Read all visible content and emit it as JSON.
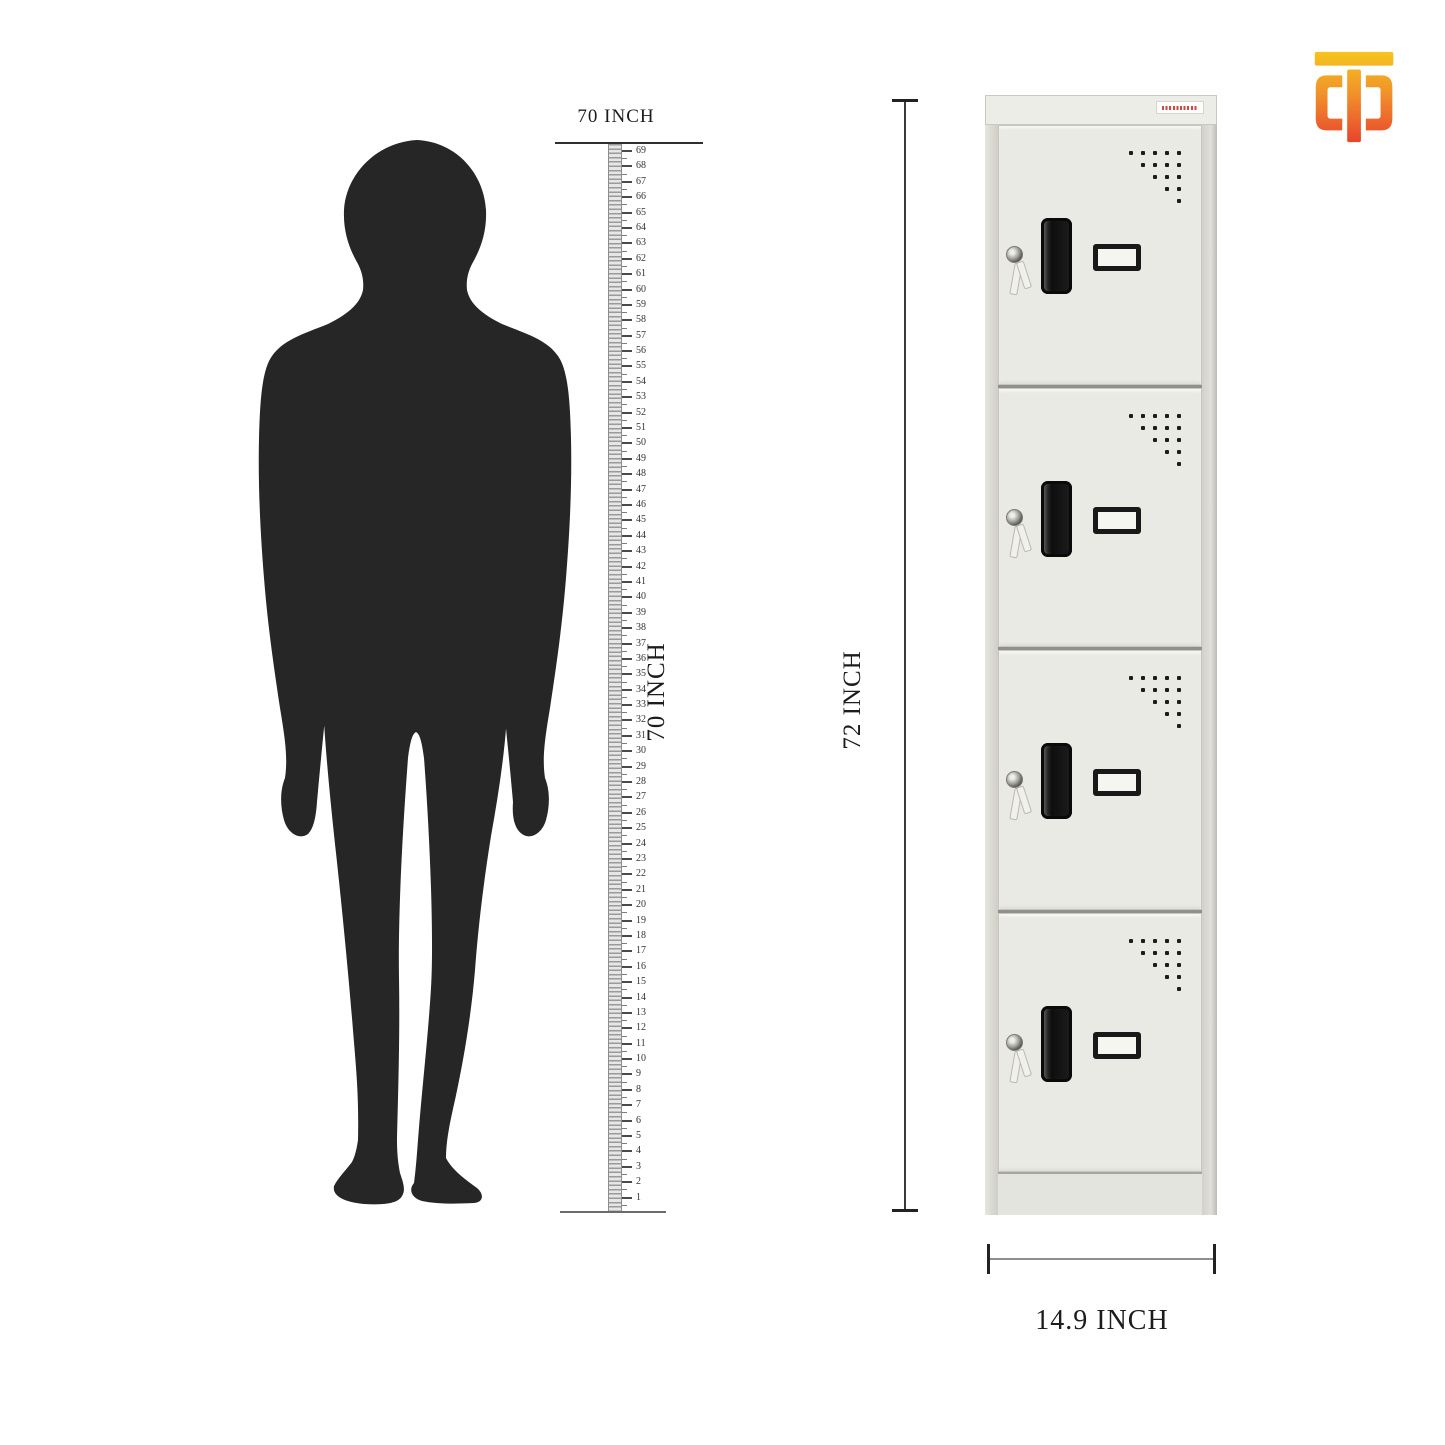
{
  "ruler": {
    "top_label": "70 INCH",
    "side_label": "70 INCH",
    "min": 1,
    "max": 69,
    "unit": "INCH"
  },
  "dimensions": {
    "height_label": "72 INCH",
    "width_label": "14.9 INCH"
  },
  "locker": {
    "door_count": 4,
    "vent_rows": [
      5,
      4,
      3,
      2,
      1
    ],
    "brand_label_color": "#cc4a42"
  },
  "colors": {
    "silhouette": "#262626",
    "door_face": "#eaeae4",
    "dimension_line": "#3a3a3a",
    "text": "#1c1c1c"
  },
  "logo": {
    "name": "TD-monogram-logo",
    "gradient": [
      "#f6ce1b",
      "#f1932a",
      "#e5352e"
    ]
  }
}
